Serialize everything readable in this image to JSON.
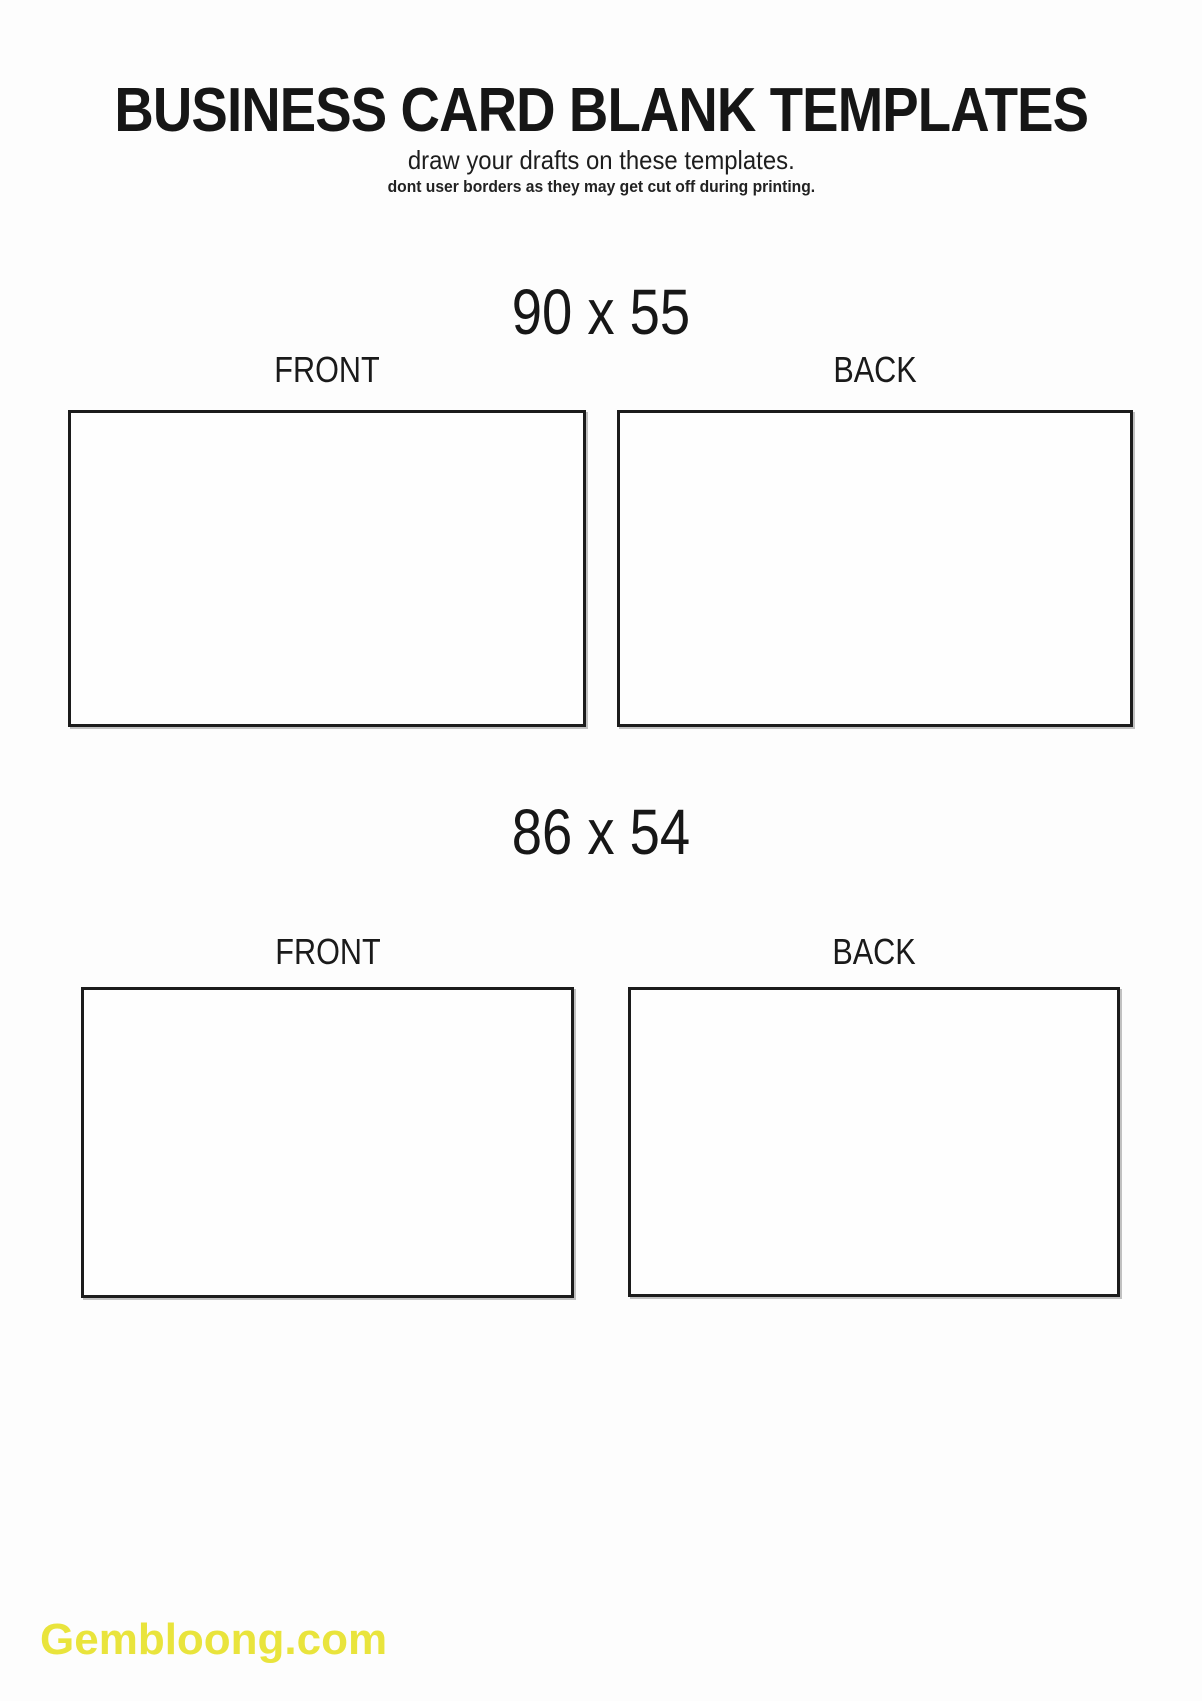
{
  "page": {
    "title": "BUSINESS CARD BLANK TEMPLATES",
    "subtitle": "draw your drafts on these templates.",
    "note": "dont user borders as they may get cut off during printing.",
    "watermark": "Gembloong.com",
    "watermark_color": "#e9e43c",
    "text_color": "#1b1b1b",
    "card_border_color": "#1c1c1c",
    "background_color": "#fdfdfd"
  },
  "sections": [
    {
      "size_label": "90 x 55",
      "front_label": "FRONT",
      "back_label": "BACK"
    },
    {
      "size_label": "86 x 54",
      "front_label": "FRONT",
      "back_label": "BACK"
    }
  ]
}
